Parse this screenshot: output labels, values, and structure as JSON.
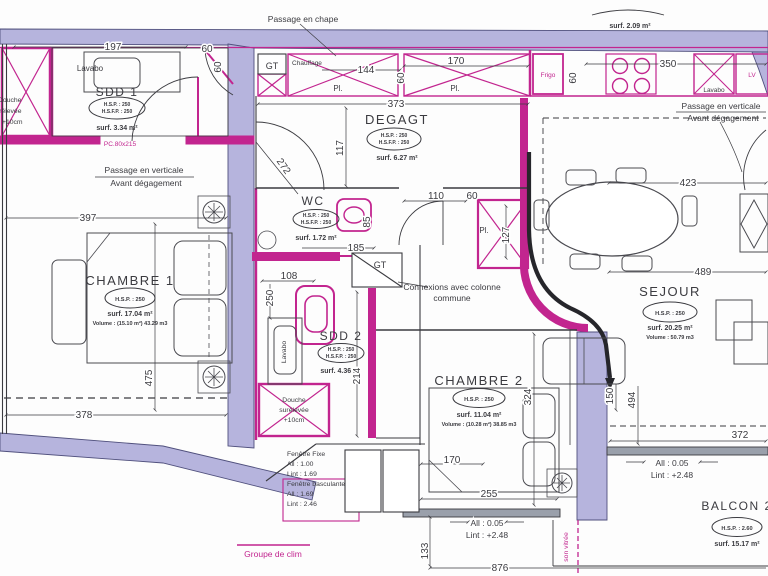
{
  "plan": {
    "rooms": {
      "sdd1": {
        "name": "SDD 1",
        "hsp": "H.S.P. : 250",
        "hsfp": "H.S.F.P. : 250",
        "surf": "surf. 3.34 m²"
      },
      "degagt": {
        "name": "DEGAGT",
        "hsp": "H.S.P. : 250",
        "hsfp": "H.S.F.P. : 250",
        "surf": "surf. 6.27 m²"
      },
      "wc": {
        "name": "WC",
        "hsp": "H.S.P. : 250",
        "hsfp": "H.S.F.P. : 250",
        "surf": "surf. 1.72 m²"
      },
      "sdd2": {
        "name": "SDD 2",
        "hsp": "H.S.P. : 250",
        "hsfp": "H.S.F.P. : 250",
        "surf": "surf. 4.36 m²"
      },
      "chambre1": {
        "name": "CHAMBRE 1",
        "hsp": "H.S.P. : 250",
        "surf": "surf. 17.04 m²",
        "volume": "Volume : (15.10 m²) 43.29 m3"
      },
      "chambre2": {
        "name": "CHAMBRE 2",
        "hsp": "H.S.P. : 250",
        "surf": "surf. 11.04 m²",
        "volume": "Volume : (10.28 m²) 38.85 m3"
      },
      "sejour": {
        "name": "SEJOUR",
        "hsp": "H.S.P. : 250",
        "surf": "surf. 20.25 m²",
        "volume": "Volume : 50.79 m3"
      },
      "balcon2": {
        "name": "BALCON 2",
        "hsp": "H.S.P. : 2.60",
        "surf": "surf. 15.17 m²"
      },
      "balcon1": {
        "surf": "surf. 2.09 m²"
      }
    },
    "fixtures": {
      "lavabo": "Lavabo",
      "frigo": "Frigo",
      "lv": "LV",
      "gt": "GT",
      "chauffage": "Chauffage",
      "pl": "Pl.",
      "douche_l1": "Douche",
      "douche_l2": "surélevée",
      "douche_l3": "+10cm",
      "pc_door": "PC.80x215",
      "groupe_clim": "Groupe de clim",
      "cloison_vitree": "son vitrée"
    },
    "notes": {
      "passage_chape": "Passage en chape",
      "passage_verticale": "Passage en verticale",
      "avant_degagement": "Avant dégagement",
      "connexions_l1": "Connexions avec colonne",
      "connexions_l2": "commune",
      "fen_fixe": "Fenêtre Fixe",
      "fen_fixe_all": "All : 1.00",
      "fen_fixe_lint": "Lint : 1.69",
      "fen_basc": "Fenêtre basculante",
      "fen_basc_all": "All : 1.69",
      "fen_basc_lint": "Lint : 2.46",
      "all_005": "All : 0.05",
      "lint_248": "Lint : +2.48"
    },
    "dims": {
      "d197": "197",
      "d60": "60",
      "d144": "144",
      "d170": "170",
      "d373": "373",
      "d117": "117",
      "d272": "272",
      "d350": "350",
      "d423": "423",
      "d489": "489",
      "d397": "397",
      "d475": "475",
      "d378": "378",
      "d185": "185",
      "d85": "85",
      "d108": "108",
      "d250": "250",
      "d110": "110",
      "d127": "127",
      "d214": "214",
      "d324": "324",
      "d255": "255",
      "d133": "133",
      "d876": "876",
      "d150": "150",
      "d494": "494",
      "d372": "372"
    },
    "colors": {
      "wall_fill": "#b6b4dd",
      "wall_edge": "#50507d",
      "pink": "#c2258f",
      "ink": "#3b3b40"
    }
  }
}
